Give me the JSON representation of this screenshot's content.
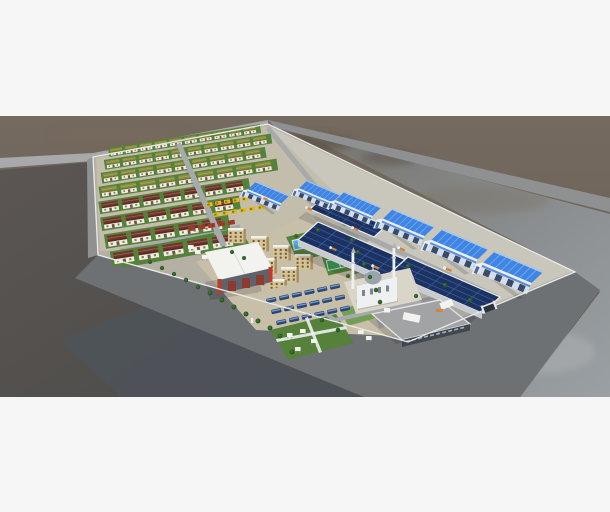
{
  "scene": {
    "type": "3d-aerial-render",
    "subject": "walled industrial and residential compound in desert terrain",
    "elements": [
      "villa-rows-green-roof",
      "villa-rows-maroon-roof",
      "apartment-blocks",
      "workshop-hall-red-columns",
      "equipment-yard-yellow",
      "equipment-yard-red",
      "blue-gable-warehouses",
      "solar-roof-warehouses",
      "mosque-with-minarets",
      "service-building",
      "bus-parking",
      "shaded-park",
      "swimming-pool",
      "sports-court",
      "roundabout",
      "perimeter-wall",
      "main-gate",
      "perimeter-roads",
      "horizon-road",
      "trees",
      "trucks"
    ]
  },
  "palette": {
    "page_bg": "#f6f6f6",
    "ground_top": "#6d6258",
    "ground_dark": "#524e4b",
    "ground_slate": "#4d535a",
    "ground_right": "#8f9396",
    "road_light": "#a7a9ab",
    "road_mid": "#8e9092",
    "asphalt": "#6e7174",
    "wall_white": "#e9ebea",
    "compound_base": "#b5b0a4",
    "housing_base": "#c3bdac",
    "concrete": "#c9c6bc",
    "lot_tan": "#c8bfa9",
    "lawn": "#56813b",
    "lawn_light": "#699a4b",
    "tree_dark": "#2c5a26",
    "tree_mid": "#3d7732",
    "roof_green": "#8a8f3e",
    "roof_maroon": "#713629",
    "house_white": "#f0ede3",
    "warehouse_blue": "#3f85e4",
    "warehouse_blue_light": "#7fb0f2",
    "warehouse_face": "#d3dfee",
    "warehouse_band": "#5b8fd8",
    "door_dark": "#3c4a66",
    "solar_navy": "#1c3260",
    "solar_grid": "#3a5da0",
    "eave_white": "#eceff2",
    "apt_tan": "#d6c293",
    "apt_side": "#a78d60",
    "apt_roof": "#f1f1ec",
    "win_dark": "#6b5b3e",
    "hall_white": "#f2f2ef",
    "hall_front": "#5d636d",
    "accent_red": "#c0392a",
    "mosque_white": "#eef0f1",
    "dome_gray": "#9aa3ab",
    "service_roof": "#a1a3a5",
    "service_front": "#42474f",
    "bus_navy": "#2a4573",
    "bus_top": "#7d9cc8",
    "pool_blue": "#4fb0e6",
    "court_green": "#3d9a52",
    "equip_yellow": "#e2ba1d",
    "equip_red": "#9c3a28",
    "truck_orange": "#d8823a"
  }
}
